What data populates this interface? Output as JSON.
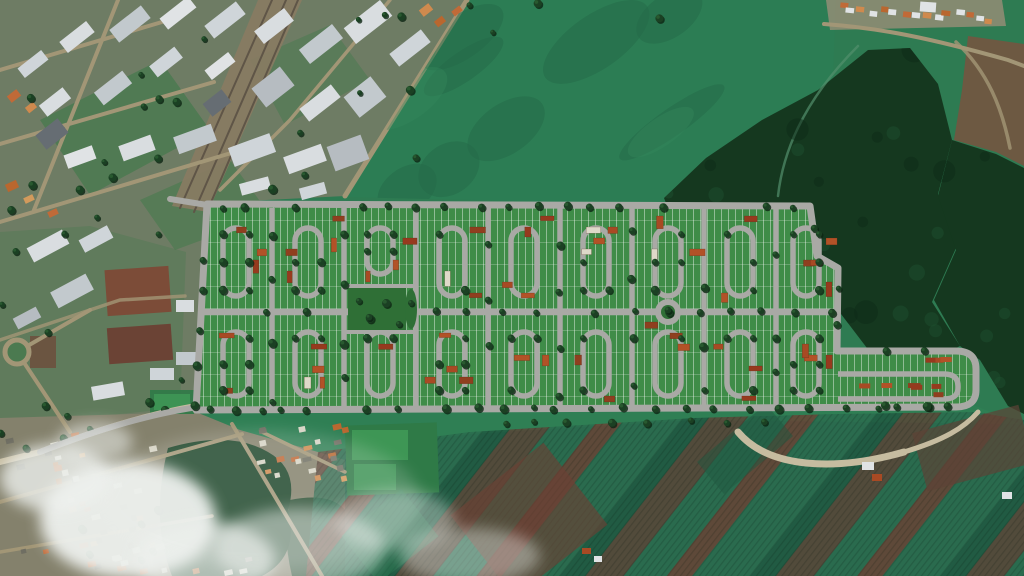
{
  "image": {
    "width": 1024,
    "height": 576,
    "description": "Satellite aerial view with a rendered residential subdivision masterplan over farmland"
  },
  "seed": 7,
  "palette": {
    "base": "#2e7b52",
    "field": "#2c7d54",
    "fieldShade": "#246a47",
    "fieldLight": "#35875c",
    "forest": "#15381f",
    "forestDark": "#0d2a18",
    "forestLight": "#1f5131",
    "urban": "#6e7c64",
    "lawn": "#4b7a50",
    "rail": "#877b62",
    "railLine": "#5f5547",
    "uroad": "#a29676",
    "sand": "#c6bca0",
    "road": "#a9a9a5",
    "lot": "#3f8c48",
    "park": "#2f6f36",
    "farm": "#2a6b4e",
    "farmDark": "#1f5740",
    "farmBrown": "#5c4336",
    "farmRed": "#6b4134",
    "buffer": "#2f8054",
    "sw": "#84816c",
    "swTree": "#1c4529",
    "sports": "#3e9655",
    "sportsBase": "#2f7a47",
    "neBrown": "#6d5942",
    "neGround": "#9a8f78",
    "trail": "#52906c",
    "dirt": "#6d4f3c",
    "dirtRed": "#6b4335",
    "bldgBrown": "#7c4c38",
    "w0": "#d9dde0",
    "w1": "#cfd5d9",
    "w2": "#c2c9cd",
    "w3": "#e0e3e5",
    "w4": "#b6bcc1",
    "dk": "#666d73",
    "o0": "#c06a38",
    "o1": "#cf8a4e",
    "o2": "#b9672f",
    "o3": "#d29a5c",
    "swGray": "#6f6e62",
    "swWhite": "#d8d5c6",
    "hr0": "#963a1e",
    "hr1": "#a84a24",
    "hr2": "#8f3f1f",
    "hr3": "#b25227",
    "hw": "#ded9c9",
    "t0": "#0c2413",
    "t1": "#1b4023",
    "t2": "#2a5c31",
    "cloud": "#eef1ee"
  },
  "scene": {
    "regions": [
      {
        "name": "pasture-field-north",
        "d": "M467,0 L836,0 L828,208 L345,197 Z",
        "fill": "field",
        "op": 1
      },
      {
        "name": "industrial-district-northwest",
        "d": "M0,0 L467,0 L345,196 L206,203 L193,412 L0,432 Z",
        "fill": "urban",
        "op": 1
      },
      {
        "name": "nw-lawn-1",
        "d": "M40,120 L160,60 L210,130 L90,195 Z",
        "fill": "lawn",
        "op": 0.85
      },
      {
        "name": "nw-lawn-2",
        "d": "M250,60 L330,25 L370,80 L285,125 Z",
        "fill": "lawn",
        "op": 0.55
      },
      {
        "name": "nw-lawn-3",
        "d": "M140,200 L230,160 L270,215 L175,250 Z",
        "fill": "lawn",
        "op": 0.7
      },
      {
        "name": "left-mid-green",
        "d": "M0,232 L90,226 L186,252 L180,408 L0,426 Z",
        "fill": "lawn",
        "op": 0.4
      },
      {
        "name": "railway-corridor",
        "d": "M258,0 L302,0 L208,212 L172,206 Z",
        "fill": "rail",
        "op": 0.95
      },
      {
        "name": "ne-town-ground",
        "d": "M826,0 L1002,0 L1006,26 L830,30 Z",
        "fill": "neGround",
        "op": 0.8
      },
      {
        "name": "ne-brown-field",
        "d": "M968,36 L1024,44 L1024,166 L996,152 L954,140 L962,90 Z",
        "fill": "neBrown",
        "op": 1
      },
      {
        "name": "farmland-south",
        "d": "M306,576 L318,452 L470,432 L694,418 L836,414 L976,412 L1024,420 L1024,576 Z",
        "fill": "farm",
        "op": 1
      },
      {
        "name": "forest-east-main",
        "d": "M664,198 L706,158 L762,120 L818,90 L868,50 L910,48 L938,84 L952,140 L938,194 L956,248 L932,302 L960,346 L920,366 L870,352 L838,310 L800,330 L756,306 L712,276 L682,244 Z",
        "fill": "forest",
        "op": 1
      },
      {
        "name": "forest-east-strip",
        "d": "M952,140 L996,154 L1024,168 L1024,414 L1008,406 L980,360 L960,346 L934,300 L956,250 L938,196 Z",
        "fill": "forest",
        "op": 1
      },
      {
        "name": "green-buffer-south",
        "d": "M196,410 L976,406 L1020,424 L694,420 L470,434 L318,454 L228,432 Z",
        "fill": "buffer",
        "op": 0.95
      },
      {
        "name": "residential-district-southwest",
        "d": "M0,418 L196,412 L240,430 L318,452 L345,460 L345,576 L0,576 Z",
        "fill": "sw",
        "op": 1
      },
      {
        "name": "tree-mass-sw-1",
        "d": "M168,448 Q230,430 268,452 Q300,470 288,510 Q300,556 262,576 L172,576 Q150,520 168,448 Z",
        "fill": "swTree",
        "op": 1
      },
      {
        "name": "tree-mass-sw-2",
        "d": "M290,500 Q330,492 345,510 L345,576 L292,576 Q282,535 290,500 Z",
        "fill": "swTree",
        "op": 0.9
      }
    ],
    "clips": {
      "field": "M467,0 L836,0 L828,208 L345,197 Z",
      "forest": [
        "M664,198 L706,158 L762,120 L818,90 L868,50 L910,48 L938,84 L952,140 L938,194 L956,248 L932,302 L960,346 L920,366 L870,352 L838,310 L800,330 L756,306 L712,276 L682,244 Z",
        "M952,140 L996,154 L1024,168 L1024,414 L1008,406 L980,360 L960,346 L934,300 L956,250 L938,196 Z"
      ],
      "farm": "M306,576 L318,452 L470,432 L694,418 L836,414 L976,412 L1024,420 L1024,576 Z"
    },
    "farm_bands": [
      [
        "farm",
        46
      ],
      [
        "farmDark",
        20
      ],
      [
        "farmBrown",
        30
      ],
      [
        "farm",
        34
      ],
      [
        "farmRed",
        20
      ]
    ],
    "patches": [
      [
        346,
        424,
        92,
        70,
        -2,
        "sportsBase",
        1
      ],
      [
        352,
        430,
        56,
        30,
        0,
        "sports",
        1
      ],
      [
        354,
        464,
        42,
        26,
        0,
        "sports",
        0.9
      ],
      [
        470,
        468,
        118,
        104,
        -38,
        "farmRed",
        0.65
      ],
      [
        918,
        418,
        110,
        60,
        -15,
        "farmBrown",
        0.7
      ],
      [
        700,
        428,
        90,
        42,
        -40,
        "farmDark",
        0.5
      ],
      [
        352,
        506,
        76,
        60,
        -38,
        "field",
        0.45
      ],
      [
        106,
        268,
        64,
        46,
        -4,
        "bldgBrown",
        1
      ],
      [
        108,
        326,
        64,
        36,
        -4,
        "dirtRed",
        1
      ],
      [
        30,
        336,
        26,
        32,
        0,
        "dirt",
        0.85
      ],
      [
        150,
        390,
        44,
        24,
        0,
        "sportsBase",
        0.9
      ],
      [
        154,
        394,
        36,
        16,
        0,
        "sports",
        0.9
      ]
    ],
    "roads": [
      {
        "d": "M467,0 L345,196",
        "c": "uroad",
        "w": 5
      },
      {
        "d": "M272,0 L180,208",
        "c": "railLine",
        "w": 2
      },
      {
        "d": "M286,0 L194,212",
        "c": "railLine",
        "w": 2
      },
      {
        "d": "M298,0 L206,214",
        "c": "railLine",
        "w": 2
      },
      {
        "d": "M0,70 L162,22",
        "c": "uroad",
        "w": 4
      },
      {
        "d": "M0,144 L214,82",
        "c": "uroad",
        "w": 4
      },
      {
        "d": "M0,222 L248,148",
        "c": "uroad",
        "w": 4
      },
      {
        "d": "M118,0 L34,210",
        "c": "uroad",
        "w": 4
      },
      {
        "d": "M390,0 L290,120 L220,190",
        "c": "uroad",
        "w": 3.5
      },
      {
        "d": "M0,340 L120,300 L185,296",
        "c": "uroad",
        "w": 3.5,
        "op": 0.8
      },
      {
        "d": "M17,352 L90,310",
        "c": "uroad",
        "w": 4
      },
      {
        "d": "M17,352 L70,432",
        "c": "uroad",
        "w": 4
      },
      {
        "d": "M232,424 L322,576",
        "c": "uroad",
        "w": 4
      },
      {
        "d": "M0,502 L242,434",
        "c": "uroad",
        "w": 4
      },
      {
        "d": "M0,552 L212,516",
        "c": "uroad",
        "w": 3.5
      },
      {
        "d": "M262,432 L345,472",
        "c": "uroad",
        "w": 3.5
      },
      {
        "d": "M824,24 C880,28 930,38 1008,60 L1024,66",
        "c": "uroad",
        "w": 4
      },
      {
        "d": "M956,42 C988,72 1002,108 1010,148",
        "c": "uroad",
        "w": 3.5,
        "op": 0.8
      },
      {
        "d": "M858,46 C812,92 784,142 778,196",
        "c": "trail",
        "w": 2.5,
        "op": 0.7
      },
      {
        "d": "M196,406 C150,414 96,430 40,452 L0,462",
        "c": "sand",
        "w": 6
      },
      {
        "d": "M738,432 C768,468 834,472 904,452",
        "c": "sand",
        "w": 7
      },
      {
        "d": "M904,452 C944,440 964,428 978,412",
        "c": "sand",
        "w": 5
      }
    ],
    "sw_roundabout": {
      "cx": 17,
      "cy": 352,
      "r": 12
    },
    "buildings": [
      [
        345,
        12,
        46,
        20,
        -38,
        "w0"
      ],
      [
        390,
        40,
        40,
        16,
        -38,
        "w1"
      ],
      [
        300,
        35,
        42,
        18,
        -38,
        "w2"
      ],
      [
        255,
        18,
        38,
        16,
        -38,
        "w0"
      ],
      [
        205,
        12,
        40,
        16,
        -38,
        "w1"
      ],
      [
        160,
        6,
        36,
        14,
        -38,
        "w3"
      ],
      [
        110,
        16,
        40,
        16,
        -38,
        "w2"
      ],
      [
        60,
        30,
        34,
        14,
        -38,
        "w0"
      ],
      [
        18,
        58,
        30,
        12,
        -38,
        "w1"
      ],
      [
        348,
        84,
        34,
        26,
        -38,
        "w2"
      ],
      [
        300,
        95,
        40,
        16,
        -38,
        "w0"
      ],
      [
        255,
        75,
        36,
        24,
        -38,
        "w4"
      ],
      [
        205,
        60,
        30,
        12,
        -38,
        "w3"
      ],
      [
        150,
        55,
        32,
        14,
        -38,
        "w1"
      ],
      [
        95,
        80,
        36,
        16,
        -38,
        "w2"
      ],
      [
        40,
        95,
        30,
        14,
        -38,
        "w0"
      ],
      [
        330,
        140,
        36,
        26,
        -20,
        "w4"
      ],
      [
        285,
        150,
        40,
        18,
        -20,
        "w0"
      ],
      [
        230,
        140,
        44,
        20,
        -20,
        "w1"
      ],
      [
        175,
        130,
        40,
        18,
        -20,
        "w2"
      ],
      [
        120,
        140,
        34,
        16,
        -20,
        "w0"
      ],
      [
        65,
        150,
        30,
        14,
        -20,
        "w3"
      ],
      [
        240,
        180,
        30,
        12,
        -15,
        "w0"
      ],
      [
        300,
        185,
        26,
        12,
        -15,
        "w1"
      ],
      [
        38,
        125,
        28,
        18,
        -38,
        "dk"
      ],
      [
        205,
        95,
        24,
        16,
        -38,
        "dk"
      ],
      [
        8,
        92,
        12,
        8,
        -38,
        "o0"
      ],
      [
        26,
        104,
        10,
        7,
        -38,
        "o1"
      ],
      [
        6,
        182,
        12,
        8,
        -25,
        "o2"
      ],
      [
        24,
        196,
        10,
        6,
        -25,
        "o3"
      ],
      [
        48,
        210,
        10,
        6,
        -25,
        "o0"
      ],
      [
        420,
        6,
        12,
        8,
        -38,
        "o1"
      ],
      [
        435,
        18,
        10,
        7,
        -38,
        "o2"
      ],
      [
        452,
        8,
        10,
        6,
        -38,
        "o0"
      ],
      [
        28,
        238,
        40,
        16,
        -28,
        "w0"
      ],
      [
        80,
        232,
        32,
        14,
        -28,
        "w1"
      ],
      [
        52,
        282,
        40,
        18,
        -28,
        "w2"
      ],
      [
        14,
        312,
        26,
        12,
        -28,
        "w4"
      ],
      [
        92,
        384,
        32,
        14,
        -10,
        "w0"
      ],
      [
        150,
        368,
        24,
        12,
        0,
        "w1"
      ],
      [
        176,
        300,
        18,
        12,
        0,
        "w0"
      ],
      [
        176,
        352,
        20,
        13,
        0,
        "w2"
      ],
      [
        862,
        462,
        12,
        8,
        0,
        "w3"
      ],
      [
        872,
        474,
        10,
        7,
        0,
        "hr1"
      ],
      [
        582,
        548,
        9,
        6,
        0,
        "hr1"
      ],
      [
        594,
        556,
        8,
        6,
        0,
        "w3"
      ],
      [
        1002,
        492,
        10,
        7,
        0,
        "w3"
      ],
      [
        920,
        2,
        16,
        10,
        4,
        "w3"
      ]
    ],
    "house_regions": [
      {
        "box": [
          4,
          430,
          162,
          566
        ],
        "n": 42
      },
      {
        "box": [
          250,
          422,
          344,
          486
        ],
        "n": 22
      },
      {
        "box": [
          58,
          556,
          250,
          574
        ],
        "n": 10
      }
    ],
    "town": {
      "x0": 838,
      "y0": 5,
      "x1": 986,
      "y1": 15,
      "n": 15
    },
    "urban_tree_regions": [
      {
        "box": [
          0,
          0,
          430,
          200
        ],
        "n": 20
      },
      {
        "box": [
          0,
          205,
          190,
          420
        ],
        "n": 12
      },
      {
        "box": [
          0,
          428,
          160,
          570
        ],
        "n": 10
      },
      {
        "box": [
          430,
          0,
          700,
          40
        ],
        "n": 4
      }
    ],
    "forest_texture": {
      "dark_n": 26,
      "light_n": 16,
      "box": [
        650,
        48,
        1020,
        410
      ]
    },
    "field_mottle": {
      "shade_n": 8,
      "light_n": 3,
      "box": [
        360,
        10,
        820,
        195
      ]
    },
    "clouds": [
      {
        "cx": 128,
        "cy": 520,
        "rx": 88,
        "ry": 58,
        "op": 0.95
      },
      {
        "cx": 55,
        "cy": 478,
        "rx": 55,
        "ry": 34,
        "op": 0.8
      },
      {
        "cx": 205,
        "cy": 560,
        "rx": 70,
        "ry": 38,
        "op": 0.7
      },
      {
        "cx": 300,
        "cy": 548,
        "rx": 85,
        "ry": 40,
        "op": 0.5
      },
      {
        "cx": 395,
        "cy": 520,
        "rx": 60,
        "ry": 30,
        "op": 0.38
      },
      {
        "cx": 470,
        "cy": 556,
        "rx": 70,
        "ry": 28,
        "op": 0.4
      },
      {
        "cx": 95,
        "cy": 442,
        "rx": 38,
        "ry": 20,
        "op": 0.55
      },
      {
        "cx": 260,
        "cy": 500,
        "rx": 160,
        "ry": 70,
        "op": 0.18
      }
    ]
  },
  "subdivision": {
    "outline": "M207,204 L810,206 L817,256 L838,268 L837,351 L956,351 Q976,351 976,369 L976,390 Q976,407 956,407 L196,410 Z",
    "entrances": [
      "M207,205 L170,199",
      "M198,407 C150,414 96,430 40,452"
    ],
    "mid_road": {
      "y": 312,
      "x0": 200,
      "x1": 834
    },
    "verticals": {
      "xs": [
        272,
        344,
        416,
        488,
        560,
        632,
        704,
        776
      ],
      "y0": 208,
      "y1": 409
    },
    "loops": {
      "centers": [
        236,
        308,
        380,
        452,
        524,
        596,
        668,
        740,
        806
      ],
      "half_w": 13,
      "top": [
        228,
        296
      ],
      "top_short": [
        228,
        274
      ],
      "short_center": 380,
      "bottom": [
        332,
        396
      ]
    },
    "park": {
      "x": 348,
      "y": 286,
      "w": 58,
      "h": 46
    },
    "park_oval": {
      "cx": 411,
      "cy": 309,
      "rx": 6,
      "ry": 20
    },
    "roundabout": {
      "cx": 668,
      "cy": 312,
      "r": 13,
      "inner": 7
    },
    "arm_lane": "M838,374 L944,374 Q958,374 958,386 L958,388 Q958,399 944,399 L838,399",
    "road_widths": {
      "perimeter": 7,
      "mid": 6.5,
      "vertical": 5.5,
      "loop": 5.5,
      "arm": 5.5,
      "entrance": 6
    },
    "bands": {
      "top": [
        212,
        306
      ],
      "bottom": [
        318,
        404
      ]
    },
    "houses": {
      "row_step": 11,
      "min": 2,
      "rand": 3,
      "white_prob": 0.1
    },
    "arm_houses": {
      "n": 9,
      "x0": 846,
      "x1": 950,
      "ys": [
        358,
        384,
        393
      ]
    },
    "tree_rows": [
      [
        210,
        207,
        806,
        207,
        30
      ],
      [
        202,
        312,
        832,
        312,
        30
      ],
      [
        198,
        410,
        952,
        407,
        26
      ],
      [
        206,
        208,
        196,
        406,
        34
      ],
      [
        812,
        210,
        816,
        254,
        30
      ],
      [
        838,
        270,
        836,
        348,
        32
      ],
      [
        842,
        352,
        956,
        352,
        42
      ],
      [
        842,
        406,
        956,
        406,
        42
      ],
      [
        470,
        423,
        830,
        421,
        34
      ]
    ]
  }
}
